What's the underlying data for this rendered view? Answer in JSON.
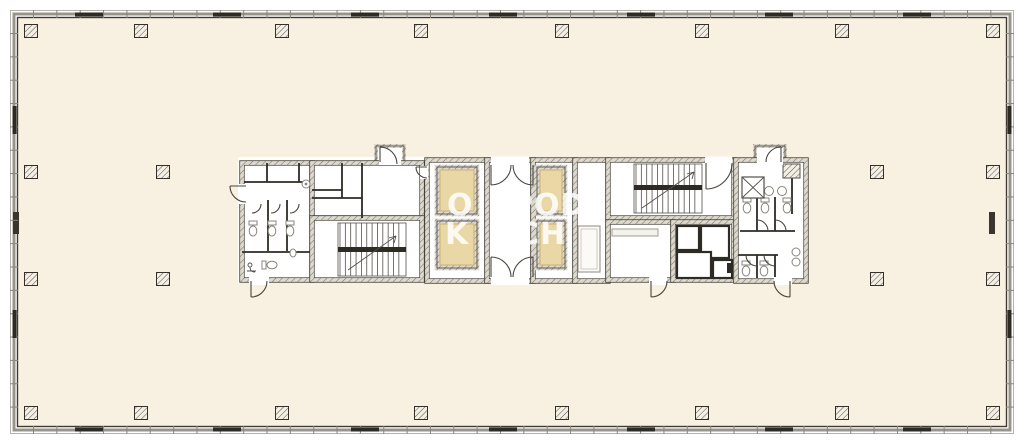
{
  "watermark": {
    "top_left": "O",
    "top_right": "POD",
    "bottom_left": "K",
    "bottom_right": "CH"
  },
  "palette": {
    "interior": "#f8f0e0",
    "shaft": "#e9d7a5",
    "shaft_inner_line": "#c9b27b",
    "wall_dark": "#2e2a24",
    "wall_hatch_bg": "#ded9cd",
    "facade_band": "#98948b",
    "fixture_gray": "#8a867d",
    "watermark": "#ffffff"
  }
}
